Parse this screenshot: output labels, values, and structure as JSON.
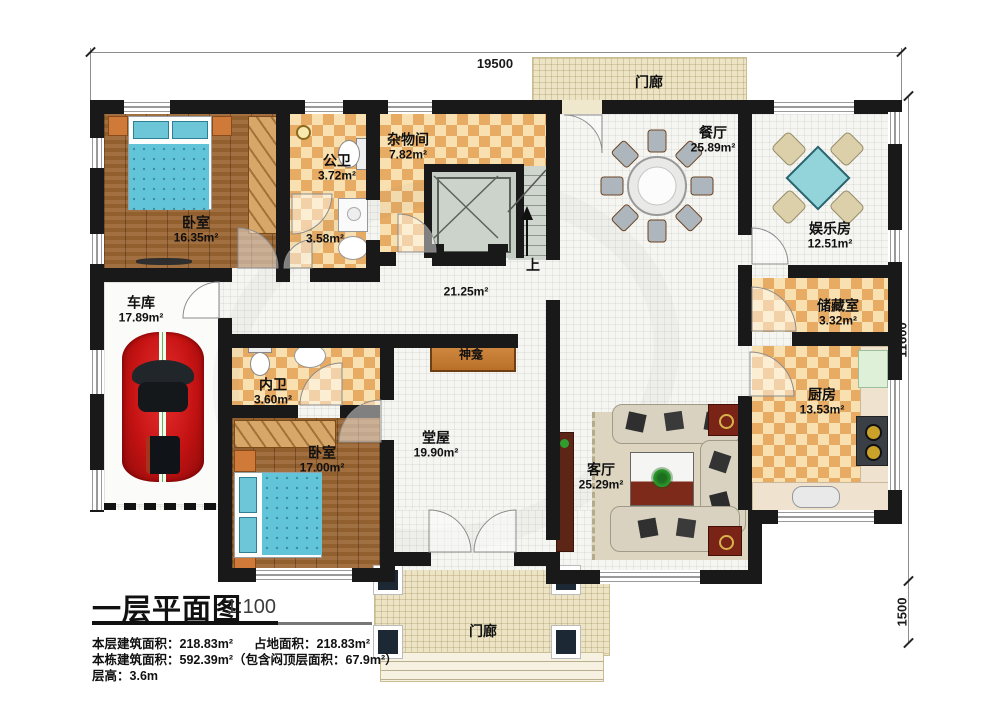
{
  "dimensions": {
    "top": "19500",
    "right_height": "11600",
    "right_porch": "1500"
  },
  "rooms": [
    {
      "name": "卧室",
      "area": "16.35m²"
    },
    {
      "name": "公卫",
      "area": "3.72m²"
    },
    {
      "name": "杂物间",
      "area": "7.82m²"
    },
    {
      "name": "",
      "area": "3.58m²"
    },
    {
      "name": "餐厅",
      "area": "25.89m²"
    },
    {
      "name": "娱乐房",
      "area": "12.51m²"
    },
    {
      "name": "储藏室",
      "area": "3.32m²"
    },
    {
      "name": "厨房",
      "area": "13.53m²"
    },
    {
      "name": "车库",
      "area": "17.89m²"
    },
    {
      "name": "内卫",
      "area": "3.60m²"
    },
    {
      "name": "卧室",
      "area": "17.00m²"
    },
    {
      "name": "堂屋",
      "area": "19.90m²"
    },
    {
      "name": "客厅",
      "area": "25.29m²"
    },
    {
      "name": "",
      "area": "21.25m²"
    }
  ],
  "annotations": {
    "porch_top": "门廊",
    "porch_bottom": "门廊",
    "shrine": "神龛",
    "stairs_up": "上"
  },
  "title_block": {
    "title": "一层平面图",
    "scale": "1:100",
    "floor_area_label": "本层建筑面积：",
    "floor_area_value": "218.83m²",
    "footprint_label": "占地面积：",
    "footprint_value": "218.83m²",
    "total_area_label": "本栋建筑面积：",
    "total_area_value": "592.39m²",
    "attic_note": "（包含闷顶层面积：67.9m²）",
    "floor_height_label": "层高：",
    "floor_height_value": "3.6m"
  }
}
